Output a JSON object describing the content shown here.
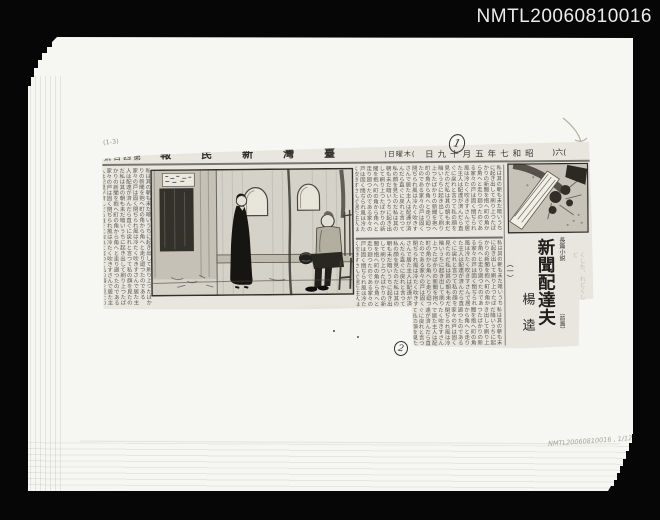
{
  "photo": {
    "catalog_id": "NMTL20060810016"
  },
  "marks": {
    "circle_1": "1",
    "circle_2": "2",
    "pencil_code": "(1-3)",
    "catalog_note": "NMTL20060810016 , 1/12"
  },
  "np": {
    "page_no": "(六)",
    "date": "昭和七年五月十九日",
    "weekday": "(木曜日)",
    "masthead": "臺灣新民報",
    "issue_no": "第四百號",
    "article": {
      "label": "長篇小説",
      "title": "新聞配達夫",
      "note": "（前篇）",
      "installment": "（一）",
      "author": "楊逵"
    },
    "filler": "私は其の朝も未だ暗いうちに起き出して刷り上つたばかりの新聞を抱へ町の角から角へと走り廻つたのである家々の戸は固く閉ぢられ風は冷たく吹きすさんで居た主人は配達が済んだら直ぐに戻れと言つて私の顔を見たのだ",
    "scrap": "くした、れど"
  }
}
